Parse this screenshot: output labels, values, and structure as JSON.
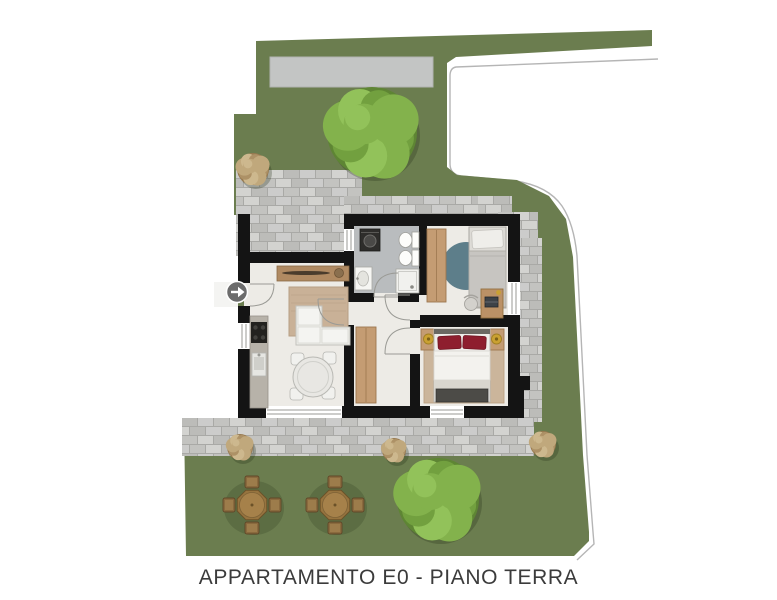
{
  "caption": {
    "text": "APPARTAMENTO E0 - PIANO TERRA"
  },
  "plan": {
    "apartment_id": "E0",
    "floor_label": "PIANO TERRA"
  },
  "entrance": {
    "marker_symbol": "→",
    "direction": "right"
  },
  "colors": {
    "background": "#ffffff",
    "lawn": "#6b7d4f",
    "paving_base": "#a9a9a6",
    "driveway": "#c3c5c4",
    "wall": "#141414",
    "floor": "#edebe6",
    "bath_floor": "#b9bcbe",
    "wood": "#c49c73",
    "wood_dark": "#9c774f",
    "rug_beige": "#c9b197",
    "rug_blue": "#5d7e8a",
    "sofa": "#ecece8",
    "bed_white": "#efeeea",
    "pillow_red": "#8e1e2e",
    "bench_gray": "#4c4b47",
    "lamp_gold": "#caa132",
    "marker_gray": "#6c6c6c",
    "boundary_line": "#b5b5b5",
    "caption_text": "#3b3b3b"
  }
}
